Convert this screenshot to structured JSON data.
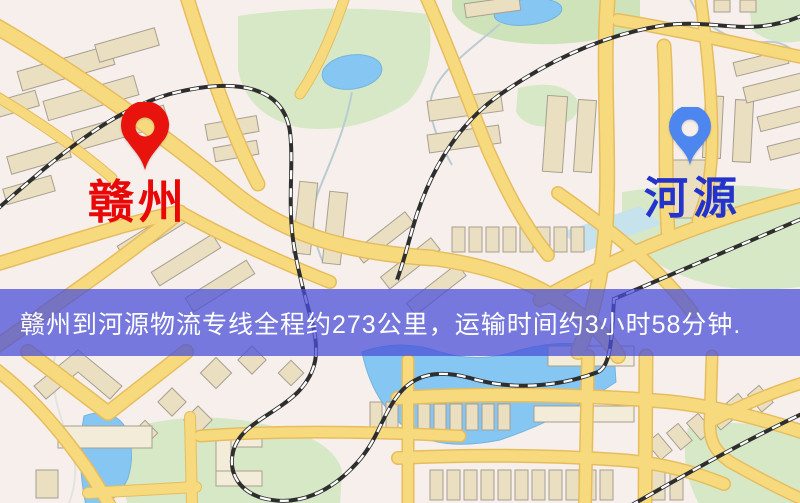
{
  "markers": {
    "origin": {
      "name": "赣州",
      "pin_color": "#e7130c",
      "label_color": "#e80808"
    },
    "destination": {
      "name": "河源",
      "pin_color": "#4d86ee",
      "label_color": "#2433cc"
    }
  },
  "banner": {
    "text": "赣州到河源物流专线全程约273公里，运输时间约3小时58分钟.",
    "background_color": "rgba(75,80,216,0.75)",
    "text_color": "#ffffff"
  },
  "theme": {
    "map_bg": "#f7efeb",
    "road": "#f8da7e",
    "road_casing": "#e6bd5e",
    "building": "#ebdfc2",
    "building_border": "#a79f90",
    "park": "#d7e8c6",
    "water": "#85c6f2",
    "water_pale": "#c6e2ec",
    "rail": "#2e2e2e",
    "rail_dash": "#ffffff",
    "stream": "#b9ccd1"
  }
}
